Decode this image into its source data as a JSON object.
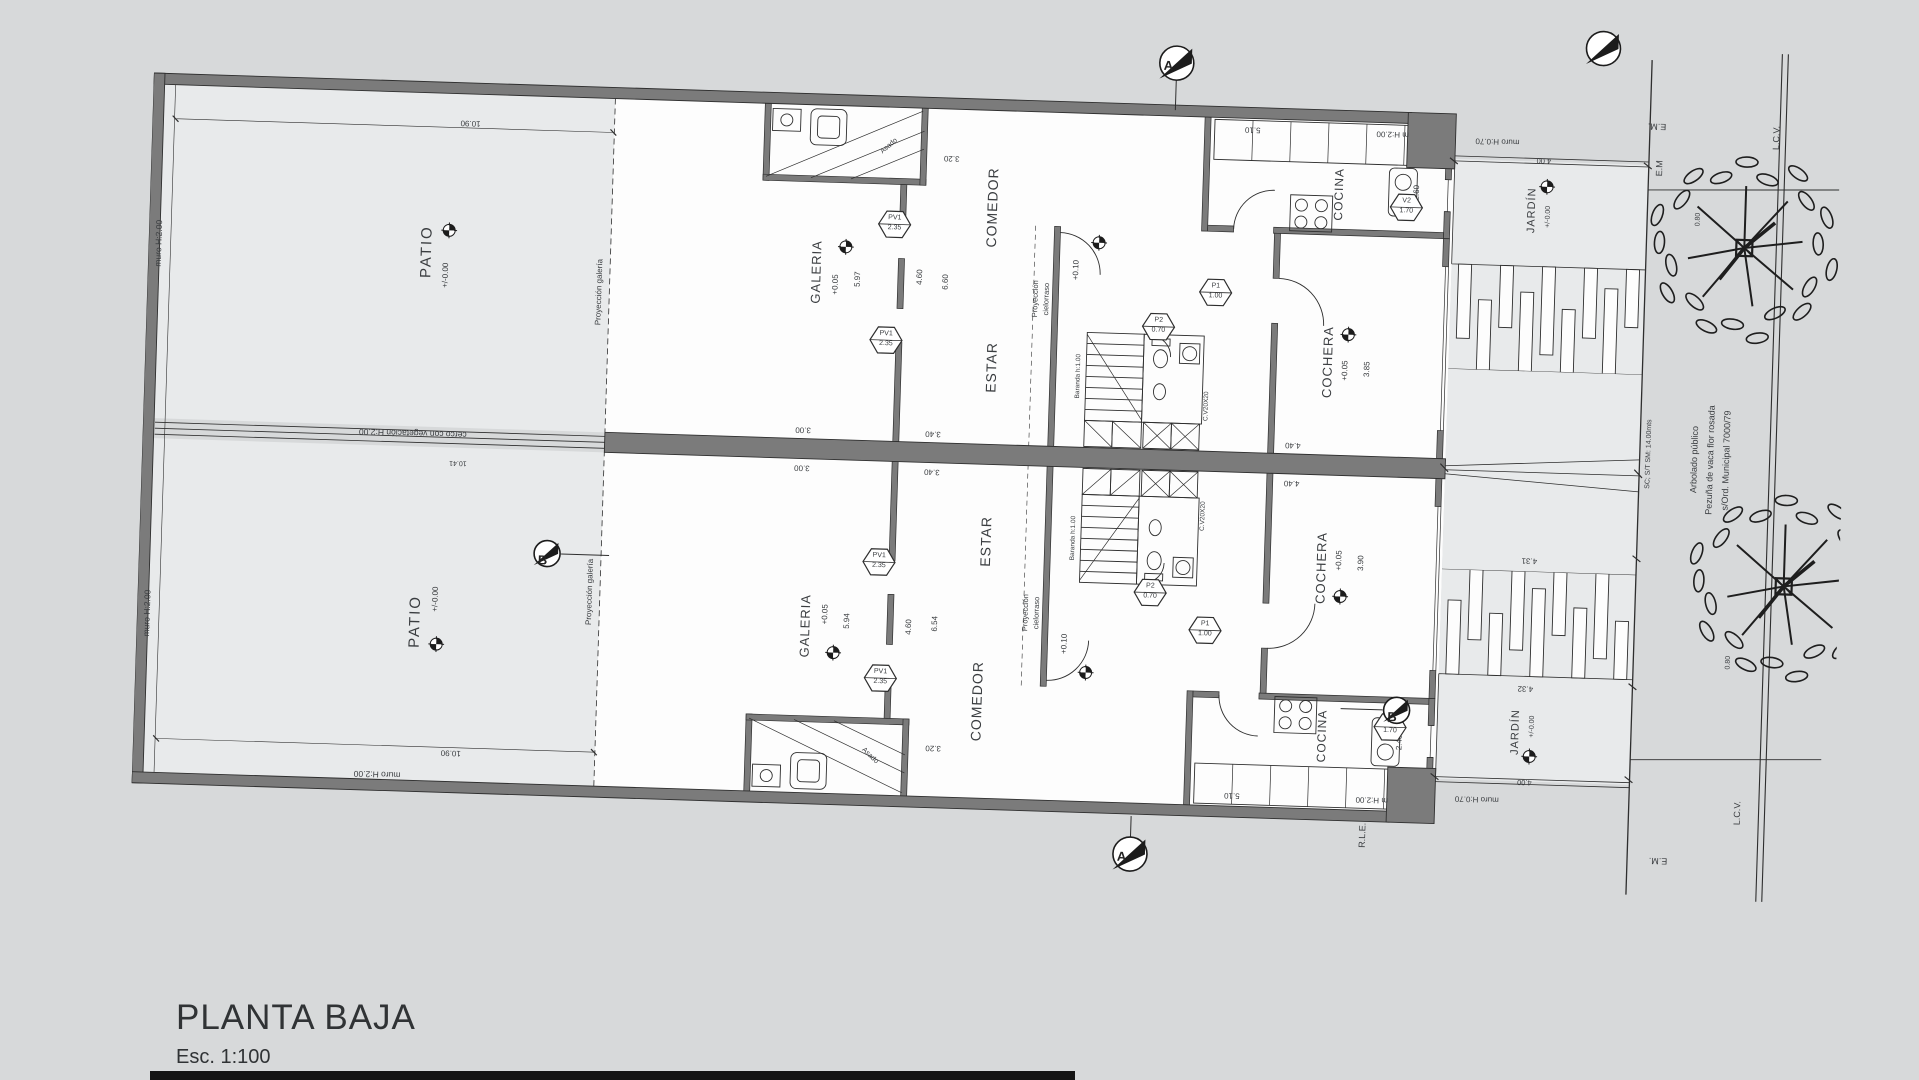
{
  "title": {
    "name": "PLANTA BAJA",
    "scale": "Esc. 1:100"
  },
  "colors": {
    "background": "#d7d9da",
    "paper": "#fdfdfd",
    "zone": "#e8eaeb",
    "wall": "#7b7b7b",
    "line": "#2e2e2e",
    "text": "#3a3d40"
  },
  "plan": {
    "labels": [
      {
        "n": "room-label-patio-a",
        "t": "PATIO",
        "x": 278,
        "y": 170,
        "r": -90,
        "s": 15,
        "ls": 2
      },
      {
        "n": "level-text-patio-a",
        "t": "+/-0.00",
        "x": 298,
        "y": 193,
        "r": -90,
        "s": 8
      },
      {
        "n": "wall-note-left-a",
        "t": "muro H:2.00",
        "x": 10,
        "y": 170,
        "r": -90,
        "s": 8.5
      },
      {
        "n": "dim-patio-a",
        "t": "10.90",
        "x": 318,
        "y": 40,
        "r": 180,
        "s": 8
      },
      {
        "n": "note-proyeccion-galeria-a",
        "t": "Proyección galería",
        "x": 452,
        "y": 205,
        "r": -90,
        "s": 8
      },
      {
        "n": "room-label-galeria-a",
        "t": "GALERIA",
        "x": 668,
        "y": 178,
        "r": -90,
        "s": 13,
        "ls": 1
      },
      {
        "n": "level-text-galeria-a",
        "t": "+0.05",
        "x": 688,
        "y": 190,
        "r": -90,
        "s": 8
      },
      {
        "n": "dim-galeria-a",
        "t": "5.97",
        "x": 710,
        "y": 184,
        "r": -90,
        "s": 8
      },
      {
        "n": "note-asado-a",
        "t": "Asado",
        "x": 737,
        "y": 50,
        "r": -42,
        "s": 7
      },
      {
        "n": "room-label-comedor-a",
        "t": "COMEDOR",
        "x": 842,
        "y": 108,
        "r": -90,
        "s": 14,
        "ls": 1
      },
      {
        "n": "room-label-estar-a",
        "t": "ESTAR",
        "x": 846,
        "y": 268,
        "r": -90,
        "s": 14,
        "ls": 1
      },
      {
        "n": "dim-comedor-window-a",
        "t": "3.20",
        "x": 800,
        "y": 60,
        "r": 180,
        "s": 8
      },
      {
        "n": "dim-galeria-depth-a",
        "t": "4.60",
        "x": 772,
        "y": 180,
        "r": -90,
        "s": 8
      },
      {
        "n": "dim-estar-depth-a",
        "t": "6.60",
        "x": 798,
        "y": 184,
        "r": -90,
        "s": 8
      },
      {
        "n": "note-proyeccion-cielorraso-a1",
        "t": "Proyección",
        "x": 888,
        "y": 198,
        "r": -90,
        "s": 7.5
      },
      {
        "n": "note-proyeccion-cielorraso-a2",
        "t": "cielorraso",
        "x": 899,
        "y": 198,
        "r": -90,
        "s": 7.5
      },
      {
        "n": "level-text-cielorraso-a",
        "t": "+0.10",
        "x": 928,
        "y": 168,
        "r": -90,
        "s": 8
      },
      {
        "n": "note-baranda-a",
        "t": "Baranda h:1.00",
        "x": 934,
        "y": 274,
        "r": -90,
        "s": 6.5
      },
      {
        "n": "note-vent-duct-a",
        "t": "C.V20X20",
        "x": 1063,
        "y": 300,
        "r": -90,
        "s": 6.5
      },
      {
        "n": "room-label-cocina-a",
        "t": "COCINA",
        "x": 1188,
        "y": 84,
        "r": -90,
        "s": 12,
        "ls": 1
      },
      {
        "n": "dim-cocina-a",
        "t": "2.60",
        "x": 1266,
        "y": 80,
        "r": -90,
        "s": 8
      },
      {
        "n": "dim-cocina-top-a",
        "t": "5.10",
        "x": 1100,
        "y": 22,
        "r": 180,
        "s": 8
      },
      {
        "n": "room-label-cochera-a",
        "t": "COCHERA",
        "x": 1182,
        "y": 252,
        "r": -90,
        "s": 13,
        "ls": 1
      },
      {
        "n": "level-text-cochera-a",
        "t": "+0.05",
        "x": 1200,
        "y": 260,
        "r": -90,
        "s": 8
      },
      {
        "n": "dim-cochera-a",
        "t": "3.85",
        "x": 1222,
        "y": 258,
        "r": -90,
        "s": 8
      },
      {
        "n": "room-label-jardin-a",
        "t": "JARDÍN",
        "x": 1382,
        "y": 94,
        "r": -90,
        "s": 11,
        "ls": 1
      },
      {
        "n": "level-text-jardin-a",
        "t": "+/-0.00",
        "x": 1398,
        "y": 100,
        "r": -90,
        "s": 7
      },
      {
        "n": "wall-note-front-a1",
        "t": "m H:2.00",
        "x": 1240,
        "y": 22,
        "r": 180,
        "s": 8
      },
      {
        "n": "wall-note-front-a2",
        "t": "muro H:0.70",
        "x": 1345,
        "y": 26,
        "r": 180,
        "s": 8
      },
      {
        "n": "dim-jardin-a",
        "t": "4.00",
        "x": 1392,
        "y": 44,
        "r": 180,
        "s": 7.5
      },
      {
        "n": "room-label-patio-b",
        "t": "PATIO",
        "x": 278,
        "y": 540,
        "r": -90,
        "s": 15,
        "ls": 2
      },
      {
        "n": "level-text-patio-b",
        "t": "+/-0.00",
        "x": 298,
        "y": 517,
        "r": -90,
        "s": 8
      },
      {
        "n": "wall-note-left-b",
        "t": "muro H:2.00",
        "x": 10,
        "y": 540,
        "r": -90,
        "s": 8.5
      },
      {
        "n": "wall-note-bottom",
        "t": "muro H:2.00",
        "x": 245,
        "y": 694,
        "r": 180,
        "s": 8.5
      },
      {
        "n": "dim-patio-b",
        "t": "10.90",
        "x": 318,
        "y": 670,
        "r": 180,
        "s": 8
      },
      {
        "n": "note-proyeccion-galeria-b",
        "t": "Proyección galería",
        "x": 452,
        "y": 505,
        "r": -90,
        "s": 8
      },
      {
        "n": "room-label-galeria-b",
        "t": "GALERIA",
        "x": 668,
        "y": 532,
        "r": -90,
        "s": 13,
        "ls": 1
      },
      {
        "n": "level-text-galeria-b",
        "t": "+0.05",
        "x": 688,
        "y": 520,
        "r": -90,
        "s": 8
      },
      {
        "n": "dim-galeria-b",
        "t": "5.94",
        "x": 710,
        "y": 526,
        "r": -90,
        "s": 8
      },
      {
        "n": "note-asado-b",
        "t": "Asado",
        "x": 737,
        "y": 660,
        "r": 42,
        "s": 7
      },
      {
        "n": "room-label-comedor-b",
        "t": "COMEDOR",
        "x": 842,
        "y": 602,
        "r": -90,
        "s": 14,
        "ls": 1
      },
      {
        "n": "room-label-estar-b",
        "t": "ESTAR",
        "x": 846,
        "y": 442,
        "r": -90,
        "s": 14,
        "ls": 1
      },
      {
        "n": "dim-comedor-window-b",
        "t": "3.20",
        "x": 800,
        "y": 650,
        "r": 180,
        "s": 8
      },
      {
        "n": "dim-galeria-depth-b",
        "t": "4.60",
        "x": 772,
        "y": 530,
        "r": -90,
        "s": 8
      },
      {
        "n": "dim-estar-depth-b",
        "t": "6.54",
        "x": 798,
        "y": 526,
        "r": -90,
        "s": 8
      },
      {
        "n": "note-proyeccion-cielorraso-b1",
        "t": "Proyección",
        "x": 888,
        "y": 512,
        "r": -90,
        "s": 7.5
      },
      {
        "n": "note-proyeccion-cielorraso-b2",
        "t": "cielorraso",
        "x": 899,
        "y": 512,
        "r": -90,
        "s": 7.5
      },
      {
        "n": "level-text-cielorraso-b",
        "t": "+0.10",
        "x": 928,
        "y": 542,
        "r": -90,
        "s": 8
      },
      {
        "n": "note-baranda-b",
        "t": "Baranda h:1.00",
        "x": 934,
        "y": 436,
        "r": -90,
        "s": 6.5
      },
      {
        "n": "note-vent-duct-b",
        "t": "C.V20X20",
        "x": 1063,
        "y": 410,
        "r": -90,
        "s": 6.5
      },
      {
        "n": "room-label-cocina-b",
        "t": "COCINA",
        "x": 1188,
        "y": 626,
        "r": -90,
        "s": 12,
        "ls": 1
      },
      {
        "n": "dim-cocina-b",
        "t": "2.46",
        "x": 1266,
        "y": 630,
        "r": -90,
        "s": 8
      },
      {
        "n": "dim-cocina-bottom-b",
        "t": "5.10",
        "x": 1100,
        "y": 688,
        "r": 180,
        "s": 8
      },
      {
        "n": "room-label-cochera-b",
        "t": "COCHERA",
        "x": 1182,
        "y": 458,
        "r": -90,
        "s": 13,
        "ls": 1
      },
      {
        "n": "level-text-cochera-b",
        "t": "+0.05",
        "x": 1200,
        "y": 450,
        "r": -90,
        "s": 8
      },
      {
        "n": "dim-cochera-b",
        "t": "3.90",
        "x": 1222,
        "y": 452,
        "r": -90,
        "s": 8
      },
      {
        "n": "room-label-jardin-b",
        "t": "JARDÍN",
        "x": 1382,
        "y": 616,
        "r": -90,
        "s": 11,
        "ls": 1
      },
      {
        "n": "level-text-jardin-b",
        "t": "+/-0.00",
        "x": 1398,
        "y": 610,
        "r": -90,
        "s": 7
      },
      {
        "n": "wall-note-front-b1",
        "t": "m H:2.00",
        "x": 1240,
        "y": 688,
        "r": 180,
        "s": 8
      },
      {
        "n": "wall-note-front-b2",
        "t": "muro H:0.70",
        "x": 1345,
        "y": 684,
        "r": 180,
        "s": 8
      },
      {
        "n": "dim-jardin-b",
        "t": "4.00",
        "x": 1392,
        "y": 666,
        "r": 180,
        "s": 7.5
      },
      {
        "n": "note-cerco",
        "t": "cerco con vegetación H:2.00",
        "x": 270,
        "y": 352,
        "r": 180,
        "s": 8.5
      },
      {
        "n": "dim-cerco",
        "t": "10.41",
        "x": 316,
        "y": 380,
        "r": 180,
        "s": 7
      },
      {
        "n": "dim-3-00-a",
        "t": "3.00",
        "x": 660,
        "y": 336,
        "r": 180,
        "s": 8
      },
      {
        "n": "dim-3-00-b",
        "t": "3.00",
        "x": 660,
        "y": 374,
        "r": 180,
        "s": 8
      },
      {
        "n": "dim-3-40-a",
        "t": "3.40",
        "x": 790,
        "y": 336,
        "r": 180,
        "s": 8
      },
      {
        "n": "dim-3-40-b",
        "t": "3.40",
        "x": 790,
        "y": 374,
        "r": 180,
        "s": 8
      },
      {
        "n": "dim-4-40-a",
        "t": "4.40",
        "x": 1150,
        "y": 336,
        "r": 180,
        "s": 8
      },
      {
        "n": "dim-4-40-b",
        "t": "4.40",
        "x": 1150,
        "y": 374,
        "r": 180,
        "s": 8
      },
      {
        "n": "dim-front-a",
        "t": "4.31",
        "x": 1390,
        "y": 444,
        "r": 180,
        "s": 8
      },
      {
        "n": "dim-front-b",
        "t": "4.32",
        "x": 1390,
        "y": 572,
        "r": 180,
        "s": 8
      },
      {
        "n": "note-rle",
        "t": "R.L.E.",
        "x": 1232,
        "y": 724,
        "r": -90,
        "s": 9
      },
      {
        "n": "note-em-top-1",
        "t": "E.M.",
        "x": 1504,
        "y": 6,
        "r": 180,
        "s": 9
      },
      {
        "n": "note-em-top-2",
        "t": "E.M",
        "x": 1508,
        "y": 48,
        "r": -90,
        "s": 9
      },
      {
        "n": "note-em-bottom",
        "t": "E.M.",
        "x": 1528,
        "y": 740,
        "r": 180,
        "s": 9
      },
      {
        "n": "note-lcv-top",
        "t": "L.C.V.",
        "x": 1624,
        "y": 14,
        "r": -90,
        "s": 9
      },
      {
        "n": "note-lcv-bottom",
        "t": "L.C.V.",
        "x": 1606,
        "y": 690,
        "r": -90,
        "s": 9
      },
      {
        "n": "note-sidewalk",
        "t": "SC; S/T SM: 14.00mts",
        "x": 1506,
        "y": 334,
        "r": -90,
        "s": 7
      },
      {
        "n": "note-arbolado-1",
        "t": "Arbolado público",
        "x": 1552,
        "y": 338,
        "r": -90,
        "s": 9
      },
      {
        "n": "note-arbolado-2",
        "t": "Pezuña de vaca flor rosada",
        "x": 1568,
        "y": 338,
        "r": -90,
        "s": 9
      },
      {
        "n": "note-arbolado-3",
        "t": "s/Ord. Municipal 7000/79",
        "x": 1584,
        "y": 338,
        "r": -90,
        "s": 9
      },
      {
        "n": "dim-tree-a",
        "t": "0.80",
        "x": 1548,
        "y": 98,
        "r": -90,
        "s": 7
      },
      {
        "n": "dim-tree-b",
        "t": "0.80",
        "x": 1592,
        "y": 540,
        "r": -90,
        "s": 7
      }
    ],
    "door_window_tags": [
      {
        "n": "tag-pv1-a1",
        "l1": "PV1",
        "l2": "2.35",
        "x": 745,
        "y": 128
      },
      {
        "n": "tag-pv1-a2",
        "l1": "PV1",
        "l2": "2.35",
        "x": 740,
        "y": 244
      },
      {
        "n": "tag-p2-a",
        "l1": "P2",
        "l2": "0.70",
        "x": 1012,
        "y": 222
      },
      {
        "n": "tag-p1-a",
        "l1": "P1",
        "l2": "1.00",
        "x": 1068,
        "y": 186
      },
      {
        "n": "tag-v2-a",
        "l1": "V2",
        "l2": "1.70",
        "x": 1256,
        "y": 95
      },
      {
        "n": "tag-pv1-b1",
        "l1": "PV1",
        "l2": "2.35",
        "x": 745,
        "y": 582
      },
      {
        "n": "tag-pv1-b2",
        "l1": "PV1",
        "l2": "2.35",
        "x": 740,
        "y": 466
      },
      {
        "n": "tag-p2-b",
        "l1": "P2",
        "l2": "0.70",
        "x": 1012,
        "y": 488
      },
      {
        "n": "tag-p1-b",
        "l1": "P1",
        "l2": "1.00",
        "x": 1068,
        "y": 524
      },
      {
        "n": "tag-v2-b",
        "l1": "V2",
        "l2": "1.70",
        "x": 1256,
        "y": 615
      }
    ],
    "level_markers": [
      {
        "n": "level-icon-patio-a",
        "x": 300,
        "y": 148
      },
      {
        "n": "level-icon-patio-b",
        "x": 300,
        "y": 562
      },
      {
        "n": "level-icon-galeria-a",
        "x": 697,
        "y": 152
      },
      {
        "n": "level-icon-galeria-b",
        "x": 697,
        "y": 558
      },
      {
        "n": "level-icon-cielorraso-a",
        "x": 950,
        "y": 140
      },
      {
        "n": "level-icon-cielorraso-b",
        "x": 950,
        "y": 570
      },
      {
        "n": "level-icon-cochera-a",
        "x": 1202,
        "y": 224
      },
      {
        "n": "level-icon-cochera-b",
        "x": 1202,
        "y": 486
      },
      {
        "n": "level-icon-jardin-a",
        "x": 1396,
        "y": 70
      },
      {
        "n": "level-icon-jardin-b",
        "x": 1396,
        "y": 640
      }
    ],
    "section_markers": [
      {
        "n": "section-marker-a-top",
        "l": "A",
        "x": 1022,
        "y": -42,
        "d": 17
      },
      {
        "n": "section-marker-a-bottom",
        "l": "A",
        "x": 1000,
        "y": 750,
        "d": 17
      },
      {
        "n": "section-marker-b-left",
        "l": "B",
        "x": 408,
        "y": 468,
        "d": 13
      },
      {
        "n": "section-marker-b-right",
        "l": "B",
        "x": 1262,
        "y": 598,
        "d": 13
      },
      {
        "n": "north-arrow",
        "l": "",
        "x": 1448,
        "y": -70,
        "d": 17
      }
    ]
  }
}
